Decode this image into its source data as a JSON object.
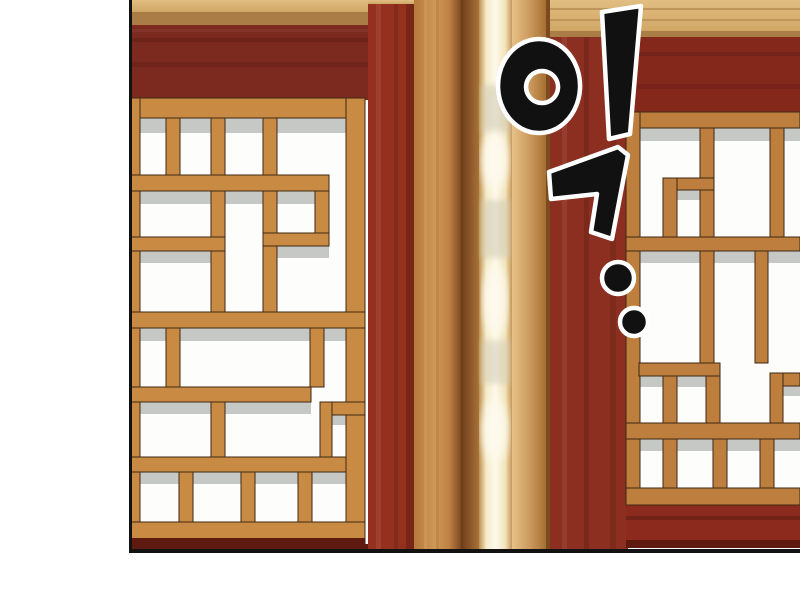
{
  "panel": {
    "type": "webtoon-comic-panel",
    "scene": "traditional lattice windows with dark red walls and a glowing door gap",
    "sfx": {
      "text": "익!",
      "style": "black glyphs with white outline, plus two emphasis dots"
    }
  },
  "palette": {
    "pageBg": "#ffffff",
    "borderBlack": "#121212",
    "paper": "#fdfdfc",
    "paperShadow": "#c6c8c6",
    "woodLattice": "#c98b43",
    "woodLatticeRight": "#bd7e3e",
    "woodOutline": "#402813",
    "beam": "#dcb579",
    "beamShadow": "#a97d45",
    "redWall": "#7c2a1f",
    "redWallRight": "#85281c",
    "redStrip": "#95301f",
    "redStripRight": "#8d2f20",
    "redSill": "#8c2b1d",
    "redDark": "#5f1a10",
    "pillar": "#c08145",
    "pillarLight": "#cf9855",
    "pillarDark": "#7c4a20",
    "recess": "#6e3b1a",
    "glowEdge": "#bd8f4e",
    "glow": "#f6ebc8",
    "glowCore": "#fdf9ec",
    "ink": "#111111",
    "inkOutline": "#ffffff"
  }
}
